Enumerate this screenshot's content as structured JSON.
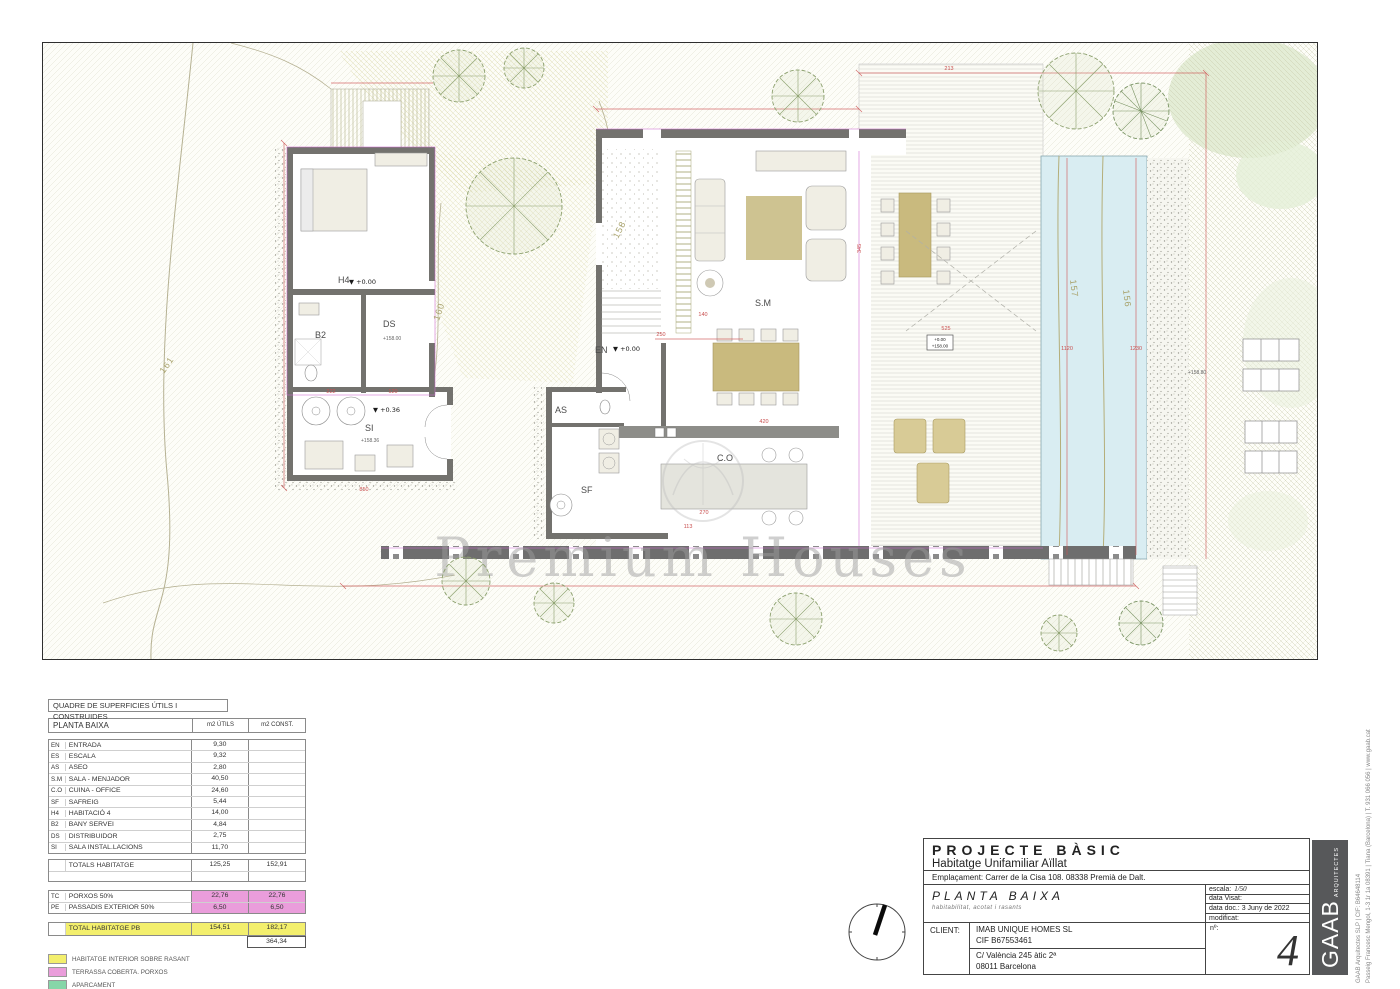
{
  "colors": {
    "dim_red": "#cc4444",
    "contour_olive": "#a8a26b",
    "pool_blue": "#d9edf2",
    "wall_gray": "#73726e",
    "highlight_yellow": "#f3ef6d",
    "highlight_pink": "#ea9ddb",
    "legend_green": "#86d6a8",
    "magenta": "#cf6ad0"
  },
  "plan": {
    "watermark": "Premium Houses",
    "rooms": {
      "h4": "H4",
      "b2": "B2",
      "ds": "DS",
      "si": "SI",
      "en": "EN",
      "as": "AS",
      "sm": "S.M",
      "co": "C.O",
      "sf": "SF"
    },
    "levels": {
      "h4": "▼ +0.00",
      "en": "▼ +0.00",
      "si": "▼ +0.36",
      "si_abs": "+158.36",
      "ds_abs": "+158.00",
      "box_rel": "+0.00",
      "box_abs": "+158.00",
      "pool": "+158.80"
    },
    "contours": {
      "c161": "161",
      "c160": "160",
      "c158": "158",
      "c157": "157",
      "c156": "156"
    },
    "dims": {
      "d213": "213",
      "d345": "345",
      "d525": "525",
      "d1120": "1120",
      "d1230": "1230",
      "d420": "420",
      "d270": "270",
      "d113": "113",
      "d140": "140",
      "d250": "250",
      "d222": "222",
      "d120": "120",
      "d850": "850"
    }
  },
  "areas_table": {
    "title": "QUADRE DE SUPERFICIES ÚTILS I CONSTRUIDES",
    "header": {
      "name": "PLANTA BAIXA",
      "utils": "m2 ÚTILS",
      "const": "m2 CONST."
    },
    "rows": [
      {
        "code": "EN",
        "name": "ENTRADA",
        "utils": "9,30",
        "const": ""
      },
      {
        "code": "ES",
        "name": "ESCALA",
        "utils": "9,32",
        "const": ""
      },
      {
        "code": "AS",
        "name": "ASEO",
        "utils": "2,80",
        "const": ""
      },
      {
        "code": "S.M",
        "name": "SALA - MENJADOR",
        "utils": "40,50",
        "const": ""
      },
      {
        "code": "C.O",
        "name": "CUINA - OFFICE",
        "utils": "24,60",
        "const": ""
      },
      {
        "code": "SF",
        "name": "SAFREIG",
        "utils": "5,44",
        "const": ""
      },
      {
        "code": "H4",
        "name": "HABITACIÓ 4",
        "utils": "14,00",
        "const": ""
      },
      {
        "code": "B2",
        "name": "BANY SERVEI",
        "utils": "4,84",
        "const": ""
      },
      {
        "code": "DS",
        "name": "DISTRIBUIDOR",
        "utils": "2,75",
        "const": ""
      },
      {
        "code": "SI",
        "name": "SALA INSTAL.LACIONS",
        "utils": "11,70",
        "const": ""
      }
    ],
    "totals": {
      "label": "TOTALS HABITATGE",
      "utils": "125,25",
      "const": "152,91"
    },
    "extras": [
      {
        "code": "TC",
        "name": "PORXOS 50%",
        "utils": "22,76",
        "const": "22,76"
      },
      {
        "code": "PE",
        "name": "PASSADIS EXTERIOR 50%",
        "utils": "6,50",
        "const": "6,50"
      }
    ],
    "total_pb": {
      "label": "TOTAL HABITATGE PB",
      "utils": "154,51",
      "const": "182,17"
    },
    "grand_total": "364,34",
    "legend": [
      {
        "label": "HABITATGE INTERIOR SOBRE RASANT",
        "color": "#f3ef6d"
      },
      {
        "label": "TERRASSA COBERTA. PORXOS",
        "color": "#ea9ddb"
      },
      {
        "label": "APARCAMENT",
        "color": "#86d6a8"
      }
    ]
  },
  "title_block": {
    "project_type": "PROJECTE BÀSIC",
    "project_subtitle": "Habitatge Unifamiliar Aïllat",
    "location": "Emplaçament: Carrer de la Cisa 108. 08338 Premià de Dalt.",
    "sheet_title": "PLANTA BAIXA",
    "sheet_subtitle": "habitabilitat, acotat i rasants",
    "escala_label": "escala:",
    "escala_value": "1/50",
    "visat_label": "data Visat:",
    "datadoc_label": "data doc.: 3 Juny de 2022",
    "modificat_label": "modificat:",
    "client_label": "CLIENT:",
    "client_name": "IMAB UNIQUE HOMES SL",
    "client_cif": "CIF B67553461",
    "client_addr1": "C/ València 245 àtic 2ª",
    "client_addr2": "08011 Barcelona",
    "num_label": "nº:",
    "sheet_number": "4",
    "firm": "GAAB",
    "firm_sub": "ARQUITECTES",
    "firm_info1": "GAAB Arquitectes SLP | CIF: B64648114",
    "firm_info2": "Passeig Francesc Mengol, 1-3 1r 1a 08391 | Tiana (Barcelona) | T. 931 066 056 | www.gaab.cat"
  }
}
